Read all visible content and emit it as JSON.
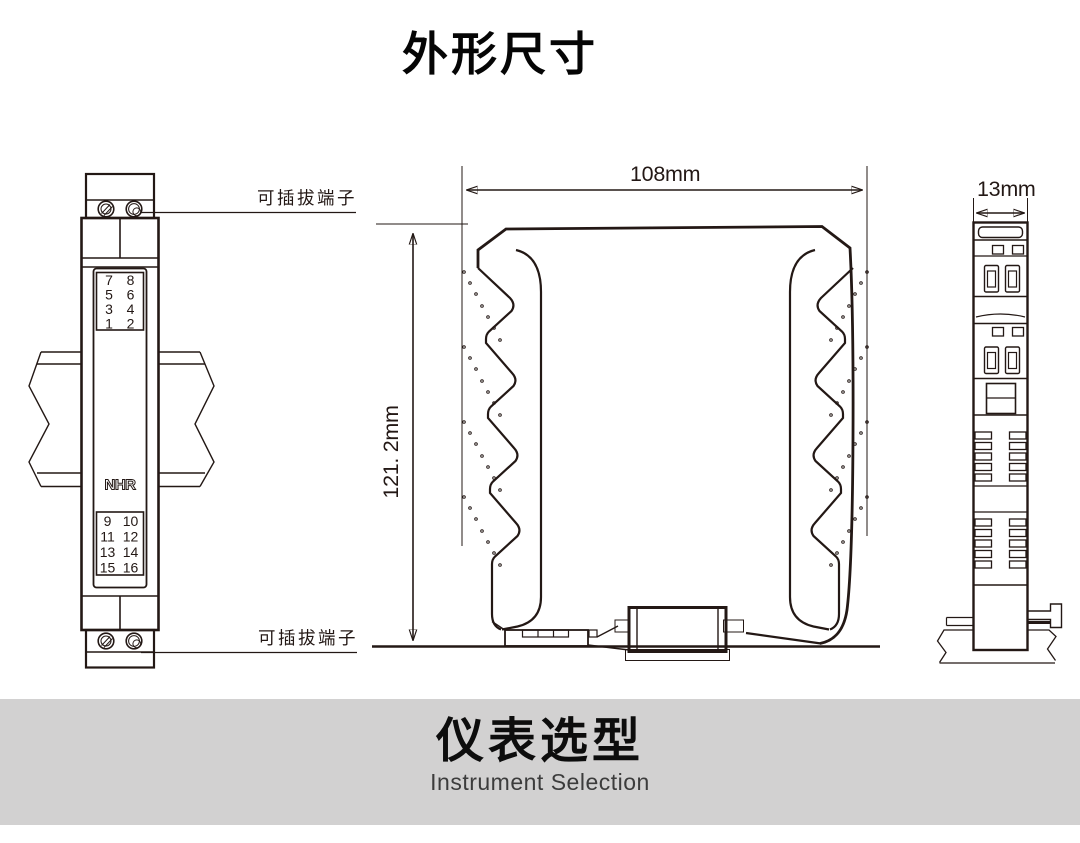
{
  "page": {
    "title": "外形尺寸"
  },
  "front_view": {
    "label_top": "可插拔端子",
    "label_bottom": "可插拔端子",
    "brand_letters": [
      "N",
      "H",
      "R"
    ],
    "terminals_top": [
      [
        "7",
        "8"
      ],
      [
        "5",
        "6"
      ],
      [
        "3",
        "4"
      ],
      [
        "1",
        "2"
      ]
    ],
    "terminals_bottom": [
      [
        "9",
        "10"
      ],
      [
        "11",
        "12"
      ],
      [
        "13",
        "14"
      ],
      [
        "15",
        "16"
      ]
    ]
  },
  "top_view": {
    "width_dim": "108mm",
    "height_dim": "121. 2mm"
  },
  "side_view": {
    "depth_dim": "13mm"
  },
  "banner": {
    "title": "仪表选型",
    "subtitle": "Instrument Selection"
  },
  "colors": {
    "line": "#231815",
    "accent_red": "#cf1a1a",
    "banner_bg": "#d2d1d1",
    "banner_subtitle": "#3c3c3c",
    "leader_line": "#8c8c8c"
  }
}
